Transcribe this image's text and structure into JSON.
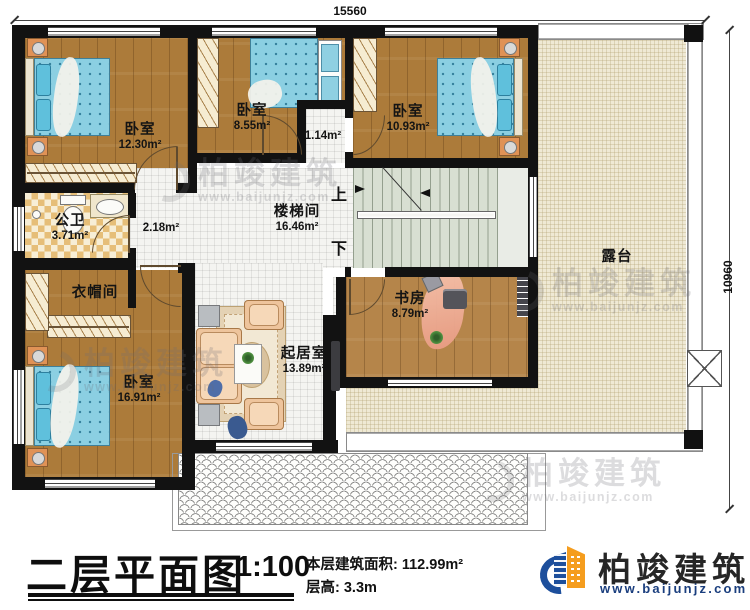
{
  "dimensions": {
    "top": "15560",
    "right": "10960"
  },
  "rooms": {
    "bedroom_tl": {
      "name": "卧室",
      "area": "12.30m²"
    },
    "bedroom_tm": {
      "name": "卧室",
      "area": "8.55m²"
    },
    "bedroom_tr": {
      "name": "卧室",
      "area": "10.93m²"
    },
    "vestibule": {
      "area": "1.14m²"
    },
    "bathroom": {
      "name": "公卫",
      "area": "3.71m²"
    },
    "hallway": {
      "area": "2.18m²"
    },
    "stairwell": {
      "name": "楼梯间",
      "area": "16.46m²"
    },
    "cloakroom": {
      "name": "衣帽间"
    },
    "bedroom_bl": {
      "name": "卧室",
      "area": "16.91m²"
    },
    "living": {
      "name": "起居室",
      "area": "13.89m²"
    },
    "study": {
      "name": "书房",
      "area": "8.79m²"
    },
    "terrace": {
      "name": "露台"
    }
  },
  "stairs": {
    "up": "上",
    "down": "下"
  },
  "footer": {
    "title": "二层平面图",
    "scale": "1:100",
    "area_line": "本层建筑面积: 112.99m²",
    "height_line": "层高: 3.3m"
  },
  "logo": {
    "brand": "柏竣建筑",
    "url": "www.baijunjz.com"
  },
  "watermark": {
    "brand": "柏竣建筑",
    "url": "www.baijunjz.com"
  },
  "colors": {
    "wall": "#121212",
    "wood": "#ac7b3a",
    "terrace": "#efe9d4",
    "stair": "#d8dfd2",
    "bed_blue": "#8bcfe2",
    "brand_blue": "#1d4f9c",
    "brand_orange": "#f59d1e"
  }
}
